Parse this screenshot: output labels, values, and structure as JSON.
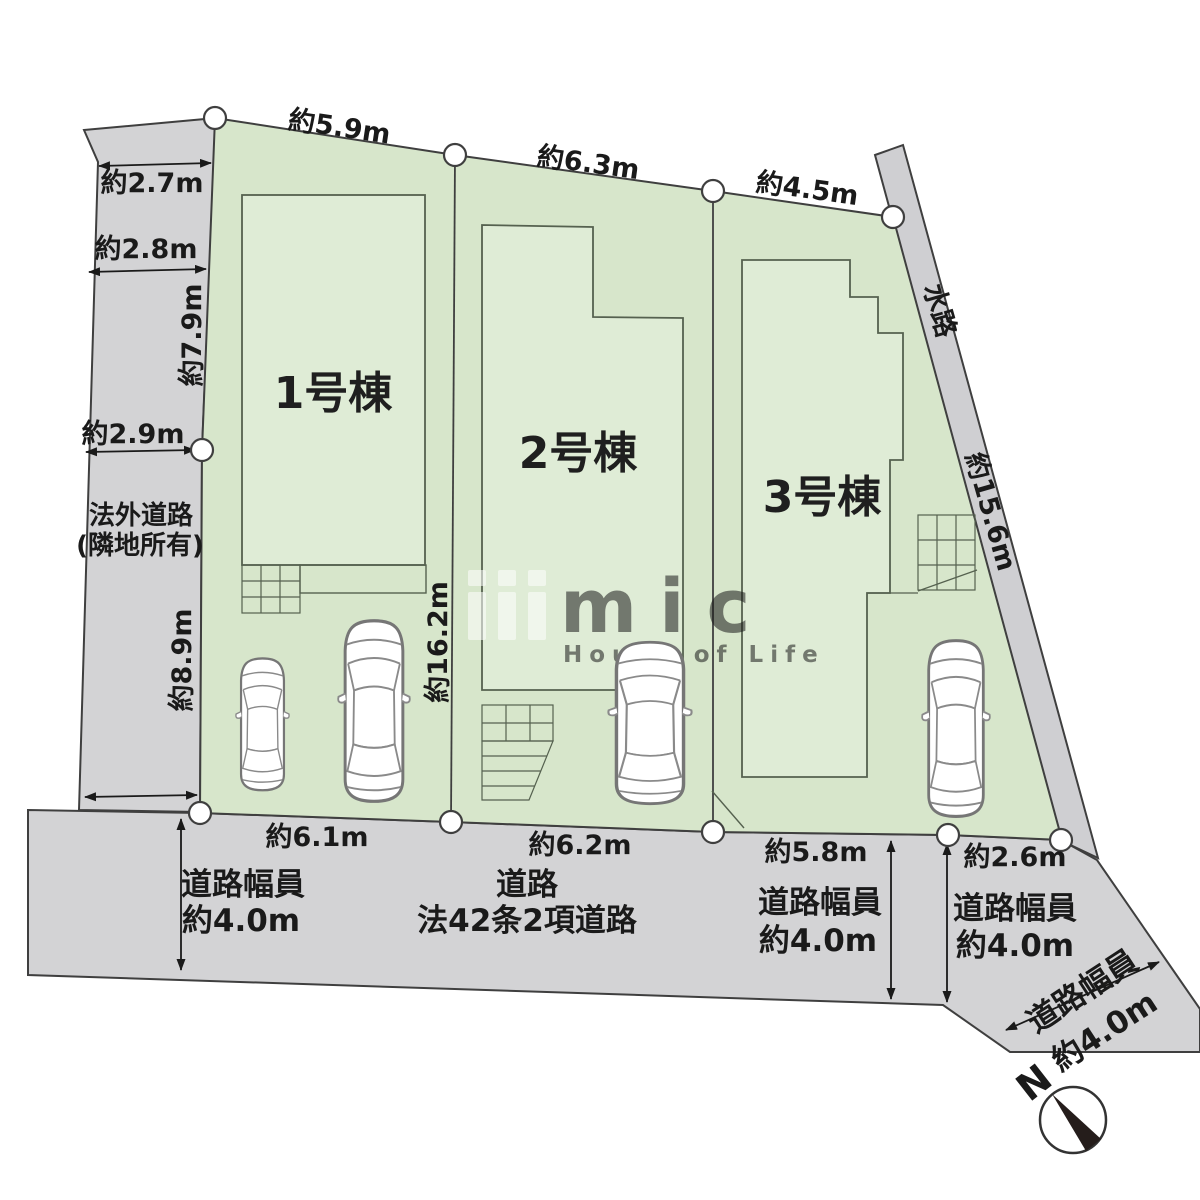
{
  "plan": {
    "buildings": [
      {
        "label": "1号棟"
      },
      {
        "label": "2号棟"
      },
      {
        "label": "3号棟"
      }
    ],
    "top_dims": [
      "約5.9m",
      "約6.3m",
      "約4.5m"
    ],
    "west_dims": {
      "w27": "約2.7m",
      "w28": "約2.8m",
      "w79": "約7.9m",
      "w29": "約2.9m",
      "w89": "約8.9m"
    },
    "west_road": {
      "line1": "法外道路",
      "line2": "(隣地所有)"
    },
    "depth_dim": "約16.2m",
    "waterway": {
      "name": "水路",
      "dim": "約15.6m"
    },
    "south_dims": [
      "約6.1m",
      "約6.2m",
      "約5.8m",
      "約2.6m"
    ],
    "roads": {
      "west_width_label": "道路幅員",
      "west_width_value": "約4.0m",
      "main_name": "道路",
      "main_type": "法42条2項道路",
      "mid_width_label": "道路幅員",
      "mid_width_value": "約4.0m",
      "east_width_label": "道路幅員",
      "east_width_value": "約4.0m",
      "diag_width_label": "道路幅員",
      "diag_width_value": "約4.0m"
    },
    "compass": {
      "north": "N"
    },
    "watermark": {
      "logo": "mic",
      "tagline": "House of Life"
    },
    "colors": {
      "lot_green": "#d7e6cb",
      "building_green": "#dfecd6",
      "road_gray": "#d3d3d5",
      "line_dark": "#3f3f3f"
    }
  }
}
